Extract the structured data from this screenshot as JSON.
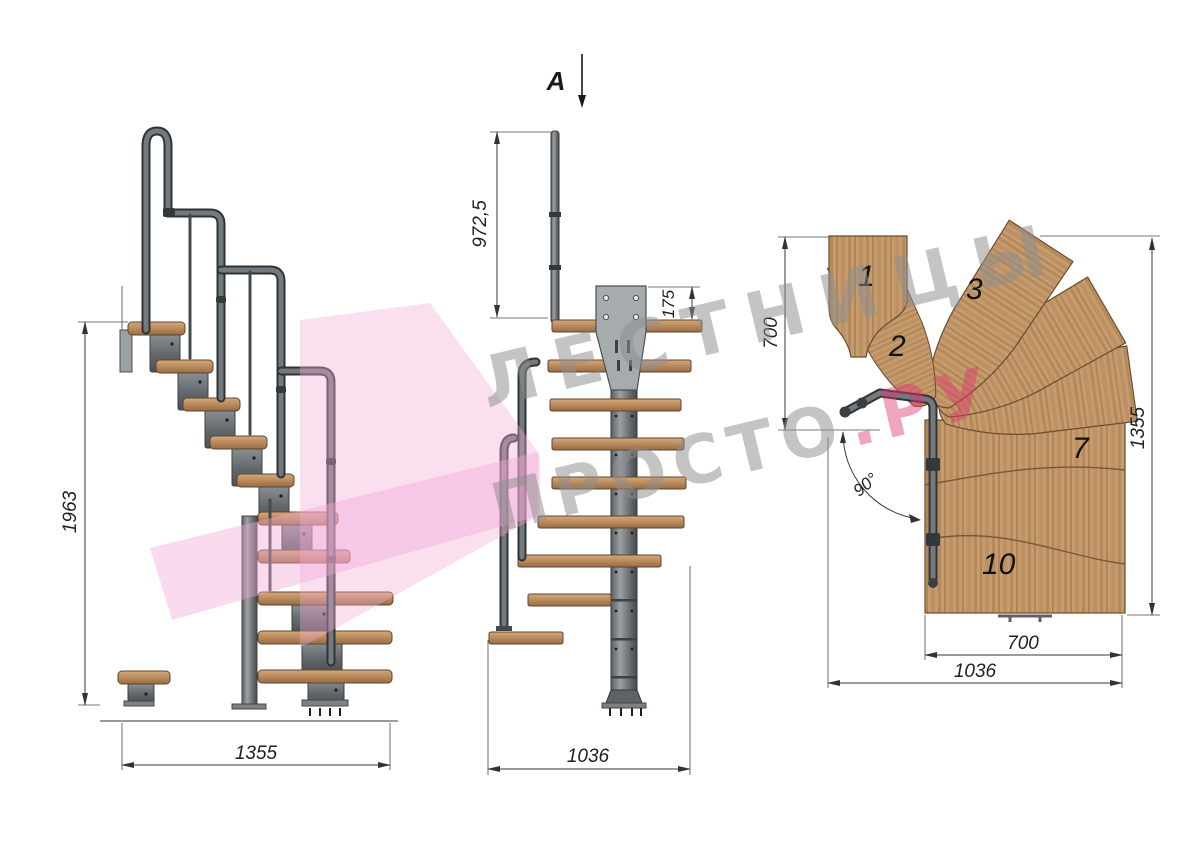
{
  "title": "staircase-technical-drawing",
  "watermark": {
    "line1": "ЛЕСТНИЦЫ",
    "line2": "ПРОСТО",
    "line2_suffix": ".РУ",
    "pink": "#e0356f",
    "gray": "#8f8f8f"
  },
  "section_marker": {
    "label": "A"
  },
  "side_view": {
    "dim_height": "1963",
    "dim_width": "1355"
  },
  "front_view": {
    "dim_post_height": "972,5",
    "dim_plate_height": "175",
    "dim_width": "1036"
  },
  "plan_view": {
    "dim_left_depth": "700",
    "dim_right_height": "1355",
    "dim_tread_width": "700",
    "dim_total_width": "1036",
    "dim_angle": "90°",
    "numbers": {
      "n1": "1",
      "n2": "2",
      "n3": "3",
      "n7": "7",
      "n10": "10"
    }
  },
  "colors": {
    "wood": "#c49c6e",
    "metal": "#6e7478",
    "accent_pink": "#f2aad6",
    "dim": "#3a3a3a"
  }
}
